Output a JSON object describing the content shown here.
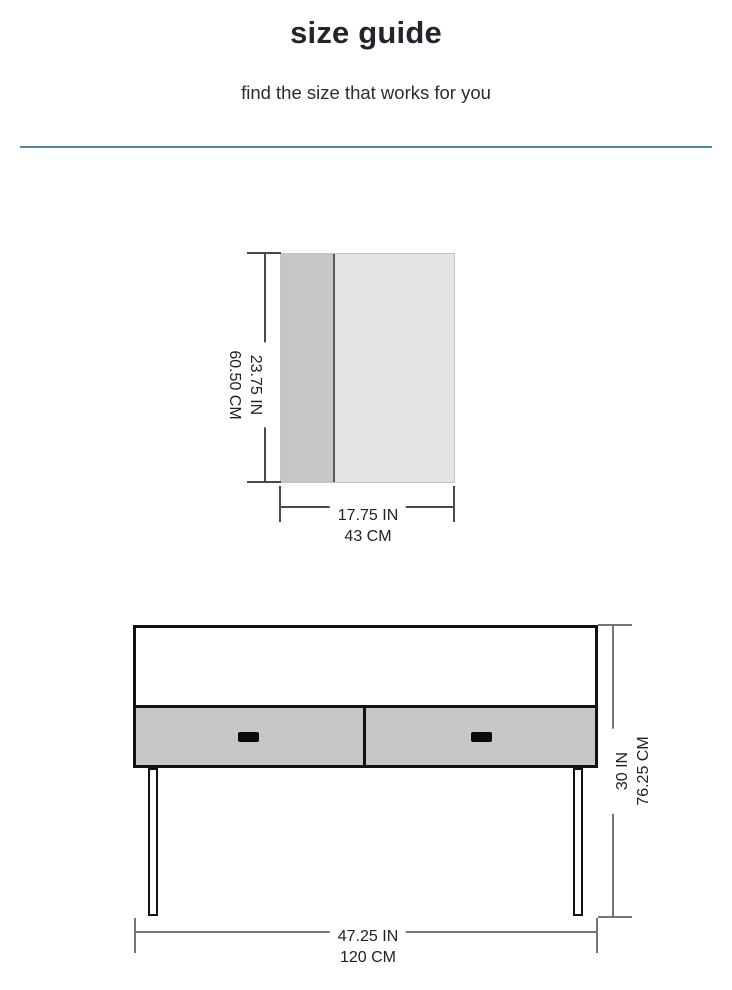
{
  "header": {
    "title": "size guide",
    "subtitle": "find the size that works for you"
  },
  "colors": {
    "divider_teal": "#4a8ca0",
    "panel_dark_gray": "#c5c6c8",
    "panel_light_gray": "#e3e4e6",
    "drawer_gray": "#c6c6c8",
    "outline_black": "#111111",
    "dim_line_dark": "#4a4a4a",
    "dim_line_gray": "#767676",
    "text_dark": "#222222"
  },
  "diagrams": [
    {
      "name": "tabletop-panel",
      "height_label": {
        "in": "23.75 IN",
        "cm": "60.50 CM"
      },
      "width_label": {
        "in": "17.75 IN",
        "cm": "43 CM"
      }
    },
    {
      "name": "console-table",
      "height_label": {
        "in": "30 IN",
        "cm": "76.25 CM"
      },
      "width_label": {
        "in": "47.25 IN",
        "cm": "120 CM"
      }
    }
  ]
}
